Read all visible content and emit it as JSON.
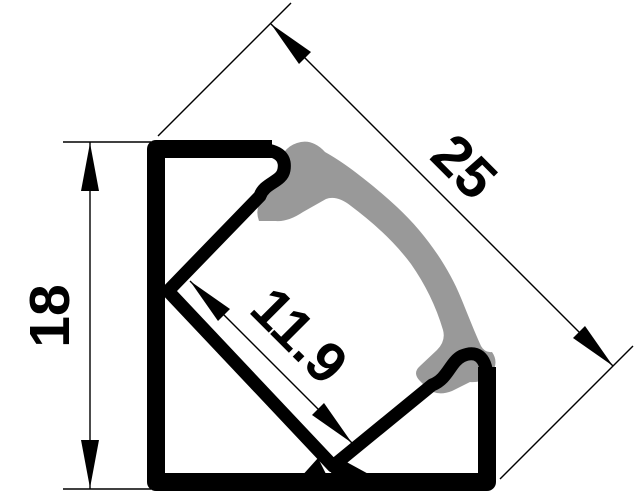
{
  "drawing": {
    "type": "technical-cross-section",
    "subject": "45-degree corner aluminium LED profile with curved diffuser lens",
    "style": "CAD dimension drawing, black line art on white"
  },
  "dimensions": {
    "height": "18",
    "diagonal": "25",
    "inner_width": "11.9"
  },
  "colors": {
    "outline": "#000000",
    "diffuser": "#999999",
    "background": "#ffffff"
  }
}
